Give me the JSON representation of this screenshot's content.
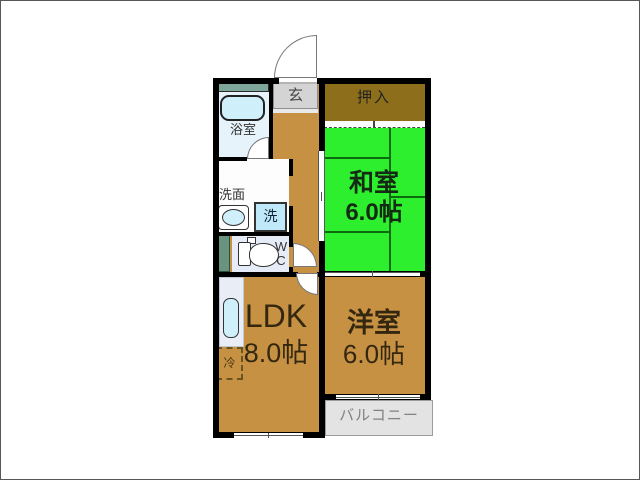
{
  "plan": {
    "type": "floor-plan",
    "rooms": {
      "genkan": {
        "label": "玄"
      },
      "oshiire": {
        "label": "押入"
      },
      "washitsu": {
        "name": "和室",
        "size": "6.0帖"
      },
      "bathroom": {
        "label": "浴室"
      },
      "washroom": {
        "label": "洗面"
      },
      "washer": {
        "label": "洗"
      },
      "wc": {
        "line1": "W",
        "line2": "C"
      },
      "fridge": {
        "label": "冷"
      },
      "ldk": {
        "name": "LDK",
        "size": "8.0帖"
      },
      "yoshitsu": {
        "name": "洋室",
        "size": "6.0帖"
      },
      "balcony": {
        "label": "バルコニー"
      }
    },
    "colors": {
      "floor": "#c79144",
      "tatami_green": "#2def2d",
      "tatami_line": "#0c6b0c",
      "closet_brown": "#8d6e1a",
      "bathroom_blue": "#e7f3fb",
      "fixture_blue": "#cfeffb",
      "wc_room": "#e6ecf7",
      "duct_teal": "#67937f",
      "genkan_gray": "#d4d4d4",
      "balcony_gray": "#e3e3e3",
      "wall": "#000000"
    }
  }
}
